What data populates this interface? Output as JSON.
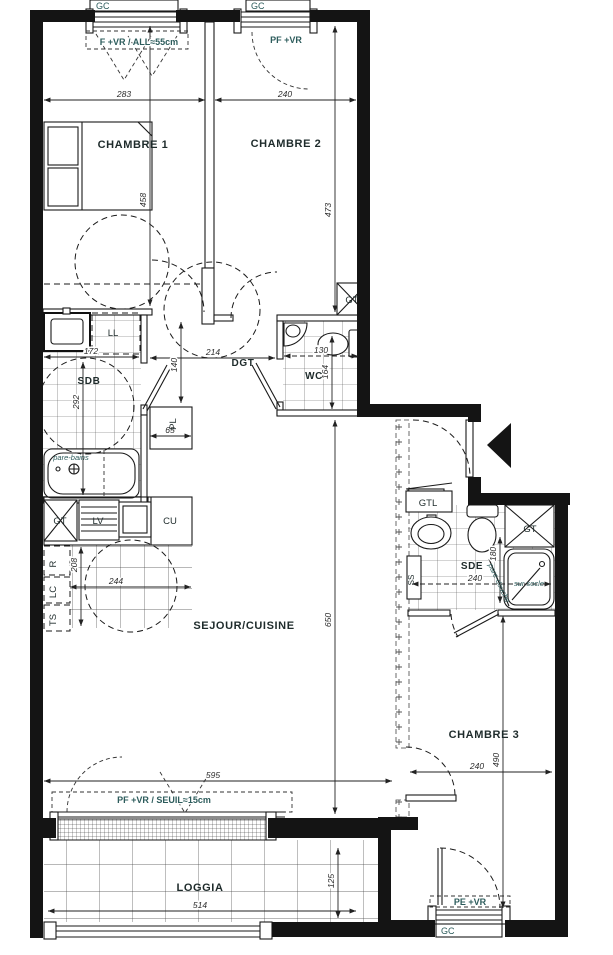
{
  "rooms": {
    "chambre1": "CHAMBRE 1",
    "chambre2": "CHAMBRE 2",
    "chambre3": "CHAMBRE 3",
    "sejour": "SEJOUR/CUISINE",
    "loggia": "LOGGIA",
    "sdb": "SDB",
    "sde": "SDE",
    "wc": "WC",
    "dgt": "DGT"
  },
  "closets": {
    "ll": "LL",
    "pl": "PL",
    "gt": "GT",
    "gtl": "GTL",
    "ss": "SS"
  },
  "kitchen": {
    "lv": "LV",
    "cu": "CU",
    "r": "R",
    "lc": "LC",
    "ts": "TS"
  },
  "windows": {
    "gc": "GC",
    "window1": "F +VR / ALL≈55cm",
    "window2": "PF +VR",
    "bay": "PF +VR / SEUIL≈15cm",
    "window3": "PE +VR"
  },
  "annotations": {
    "pare_bains": "pare-bains",
    "pare_douche": "pare-douche",
    "sur_socle": "sur socle"
  },
  "dimensions": {
    "chambre1_width": "283",
    "chambre2_width": "240",
    "chambre1_height": "458",
    "chambre2_height": "473",
    "sdb_width": "172",
    "sdb_height": "292",
    "dgt_width": "214",
    "dgt_height": "140",
    "wc_width": "130",
    "wc_height": "164",
    "pl_width": "65",
    "kitchen_width": "244",
    "kitchen_height": "208",
    "sejour_width": "595",
    "sejour_height": "650",
    "sde_width": "240",
    "sde_height": "180",
    "chambre3_width": "240",
    "chambre3_height": "490",
    "loggia_width": "514",
    "loggia_height": "125"
  },
  "colors": {
    "wall": "#141414",
    "line": "#1a1a1a",
    "label_teal": "#2d5c5c"
  }
}
